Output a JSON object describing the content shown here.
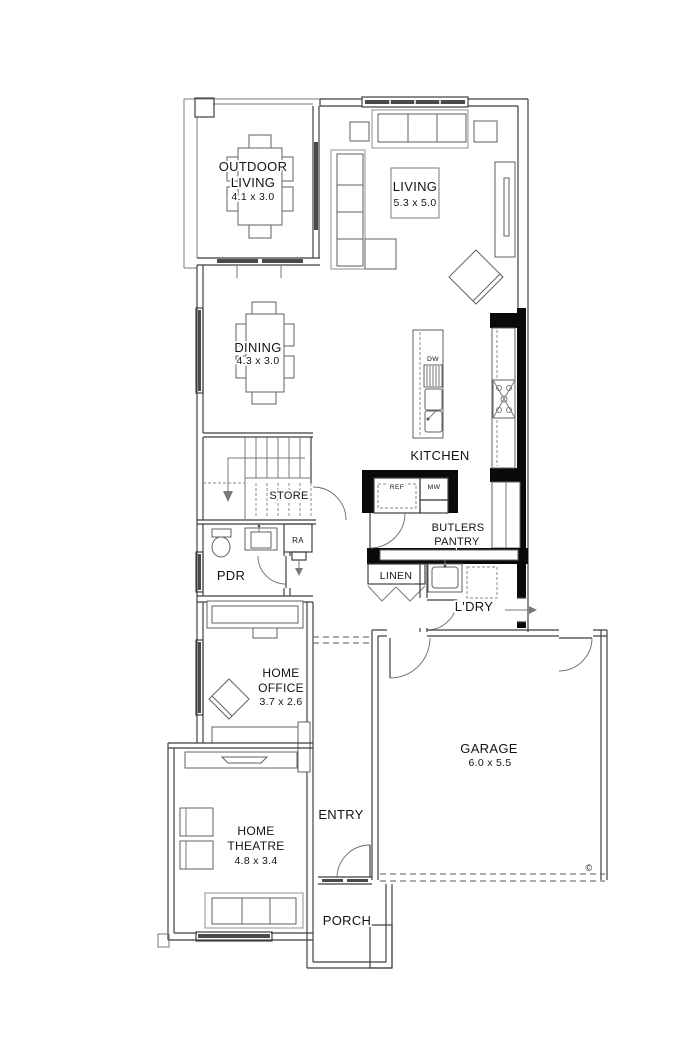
{
  "rooms": {
    "outdoor_living": {
      "line1": "OUTDOOR",
      "line2": "LIVING",
      "dims": "4.1 x 3.0"
    },
    "living": {
      "name": "LIVING",
      "dims": "5.3 x 5.0"
    },
    "dining": {
      "name": "DINING",
      "dims": "4.3 x 3.0"
    },
    "kitchen": {
      "name": "KITCHEN"
    },
    "store": {
      "name": "STORE"
    },
    "ra": {
      "name": "RA"
    },
    "pdr": {
      "name": "PDR"
    },
    "butlers_pantry": {
      "line1": "BUTLERS",
      "line2": "PANTRY"
    },
    "linen": {
      "name": "LINEN"
    },
    "laundry": {
      "name": "L'DRY"
    },
    "home_office": {
      "line1": "HOME",
      "line2": "OFFICE",
      "dims": "3.7 x 2.6"
    },
    "entry": {
      "name": "ENTRY"
    },
    "garage": {
      "name": "GARAGE",
      "dims": "6.0 x 5.5"
    },
    "home_theatre": {
      "line1": "HOME",
      "line2": "THEATRE",
      "dims": "4.8 x 3.4"
    },
    "porch": {
      "name": "PORCH"
    }
  },
  "appliances": {
    "dishwasher": "DW",
    "fridge": "REF",
    "microwave": "MW"
  },
  "annotations": {
    "copyright": "©"
  },
  "colors": {
    "wall_line": "#3f3f3f",
    "furniture_line": "#9a9a9a",
    "cabinet_fill": "#0a0a0a",
    "glazing_fill": "#4a4a4a",
    "background": "#ffffff"
  }
}
